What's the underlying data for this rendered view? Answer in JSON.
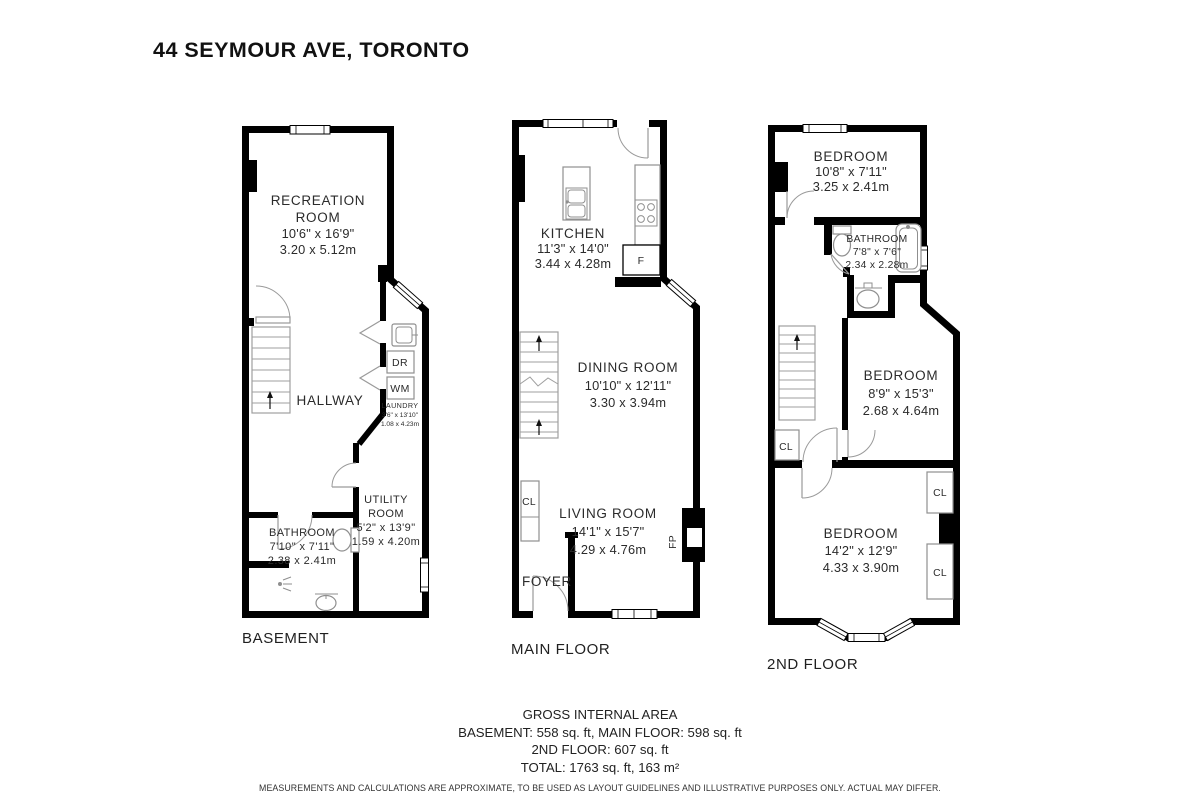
{
  "palette": {
    "wall": "#000000",
    "fixture": "#8f8f8f",
    "text": "#2b2b2b"
  },
  "title": "44 SEYMOUR AVE, TORONTO",
  "floors": {
    "basement": {
      "caption": "BASEMENT",
      "recreation": {
        "line1": "RECREATION",
        "line2": "ROOM",
        "imperial": "10'6\" x 16'9\"",
        "metric": "3.20 x 5.12m"
      },
      "hallway": "HALLWAY",
      "laundry": {
        "name": "LAUNDRY",
        "imperial": "3'6\" x 13'10\"",
        "metric": "1.08 x 4.23m"
      },
      "dryer": "DR",
      "washer": "WM",
      "bathroom": {
        "name": "BATHROOM",
        "imperial": "7'10\" x 7'11\"",
        "metric": "2.38 x 2.41m"
      },
      "utility": {
        "line1": "UTILITY",
        "line2": "ROOM",
        "imperial": "5'2\" x 13'9\"",
        "metric": "1.59 x 4.20m"
      }
    },
    "main": {
      "caption": "MAIN FLOOR",
      "kitchen": {
        "name": "KITCHEN",
        "imperial": "11'3\" x 14'0\"",
        "metric": "3.44 x 4.28m"
      },
      "dining": {
        "name": "DINING ROOM",
        "imperial": "10'10\" x 12'11\"",
        "metric": "3.30 x 3.94m"
      },
      "living": {
        "name": "LIVING ROOM",
        "imperial": "14'1\" x 15'7\"",
        "metric": "4.29 x 4.76m"
      },
      "foyer": "FOYER",
      "closet": "CL",
      "fridge": "F",
      "fireplace": "FP"
    },
    "second": {
      "caption": "2ND FLOOR",
      "bedroom1": {
        "name": "BEDROOM",
        "imperial": "10'8\" x 7'11\"",
        "metric": "3.25 x 2.41m"
      },
      "bathroom": {
        "name": "BATHROOM",
        "imperial": "7'8\" x 7'6\"",
        "metric": "2.34 x 2.28m"
      },
      "bedroom2": {
        "name": "BEDROOM",
        "imperial": "8'9\" x 15'3\"",
        "metric": "2.68 x 4.64m"
      },
      "bedroom3": {
        "name": "BEDROOM",
        "imperial": "14'2\" x 12'9\"",
        "metric": "4.33 x 3.90m"
      },
      "closet": "CL"
    }
  },
  "footer": {
    "heading": "GROSS INTERNAL AREA",
    "line1": "BASEMENT: 558 sq. ft, MAIN FLOOR: 598 sq. ft",
    "line2": "2ND FLOOR: 607 sq. ft",
    "line3": "TOTAL: 1763 sq. ft, 163 m²",
    "disclaimer": "MEASUREMENTS AND CALCULATIONS ARE APPROXIMATE, TO BE USED AS LAYOUT GUIDELINES AND ILLUSTRATIVE PURPOSES ONLY.  ACTUAL MAY DIFFER."
  }
}
